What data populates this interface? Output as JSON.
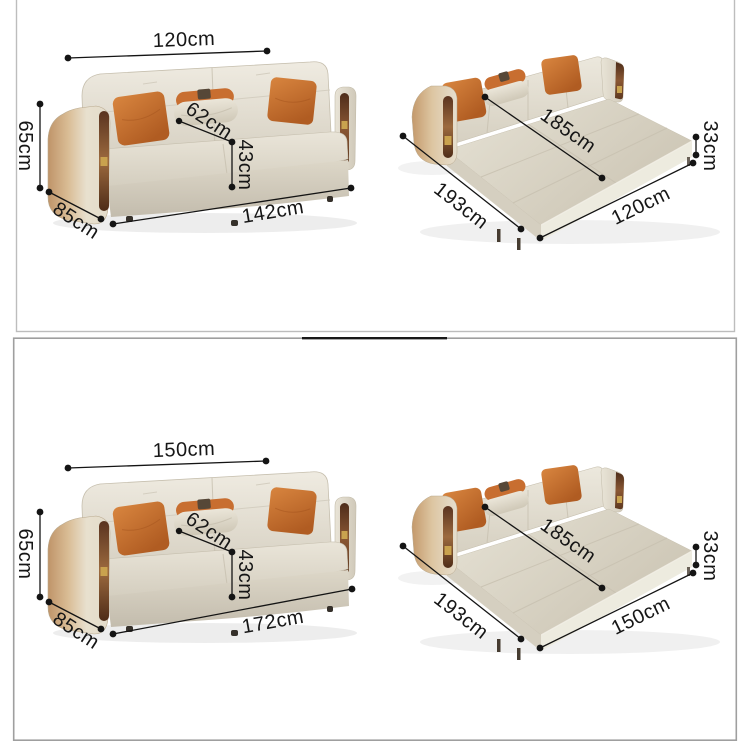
{
  "page": {
    "background": "#ffffff"
  },
  "panels": [
    {
      "id": "size-142",
      "sofa": {
        "back_width": "120cm",
        "height": "65cm",
        "seat_depth": "62cm",
        "seat_height": "43cm",
        "side_depth": "85cm",
        "overall_width": "142cm"
      },
      "bed": {
        "sleep_length": "185cm",
        "mattress_height": "33cm",
        "overall_length": "193cm",
        "sleep_width": "120cm"
      }
    },
    {
      "id": "size-172",
      "sofa": {
        "back_width": "150cm",
        "height": "65cm",
        "seat_depth": "62cm",
        "seat_height": "43cm",
        "side_depth": "85cm",
        "overall_width": "172cm"
      },
      "bed": {
        "sleep_length": "185cm",
        "mattress_height": "33cm",
        "overall_length": "193cm",
        "sleep_width": "150cm"
      }
    }
  ],
  "colors": {
    "fabric_light": "#e9e4d8",
    "fabric_dark": "#cfc8b8",
    "pillow_orange": "#c97434",
    "wood_trim": "#6e3f24",
    "metal_gold": "#c9a24e",
    "dimension_ink": "#141414",
    "panel_border": "#b5b5b5"
  }
}
